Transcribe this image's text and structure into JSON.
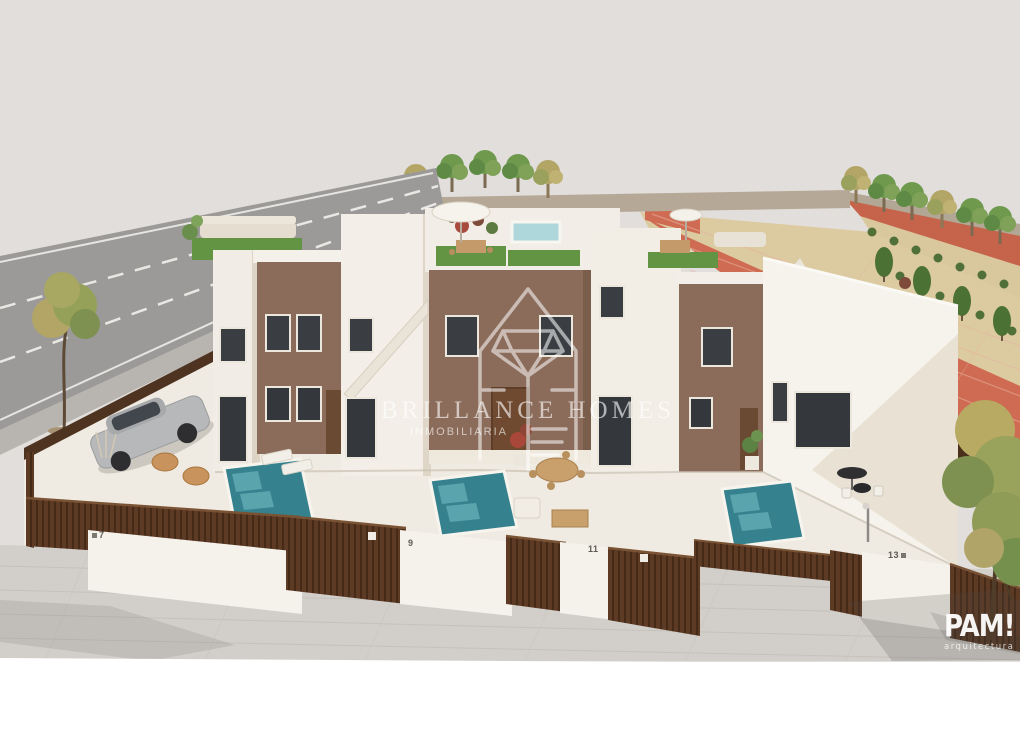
{
  "watermark": {
    "brand_line1": "BRILLANCE HOMES",
    "brand_line2": "INMOBILIARIA"
  },
  "studio_logo": {
    "name": "PAM!",
    "subtitle": "arquitectura"
  },
  "plots": [
    {
      "number": "7"
    },
    {
      "number": "9"
    },
    {
      "number": "11"
    },
    {
      "number": "13"
    }
  ],
  "palette": {
    "sky": "#e1dedb",
    "house_white": "#f3efe8",
    "facade_brown": "#8b6c5a",
    "fence_brown": "#5d3a24",
    "pool_teal": "#35828e",
    "turf_green": "#639444",
    "court_red": "#cf6b52",
    "sand": "#d9c79e",
    "road_gray": "#9b9a98",
    "pavement": "#d2cfca",
    "watermark_white": "#ffffff"
  }
}
